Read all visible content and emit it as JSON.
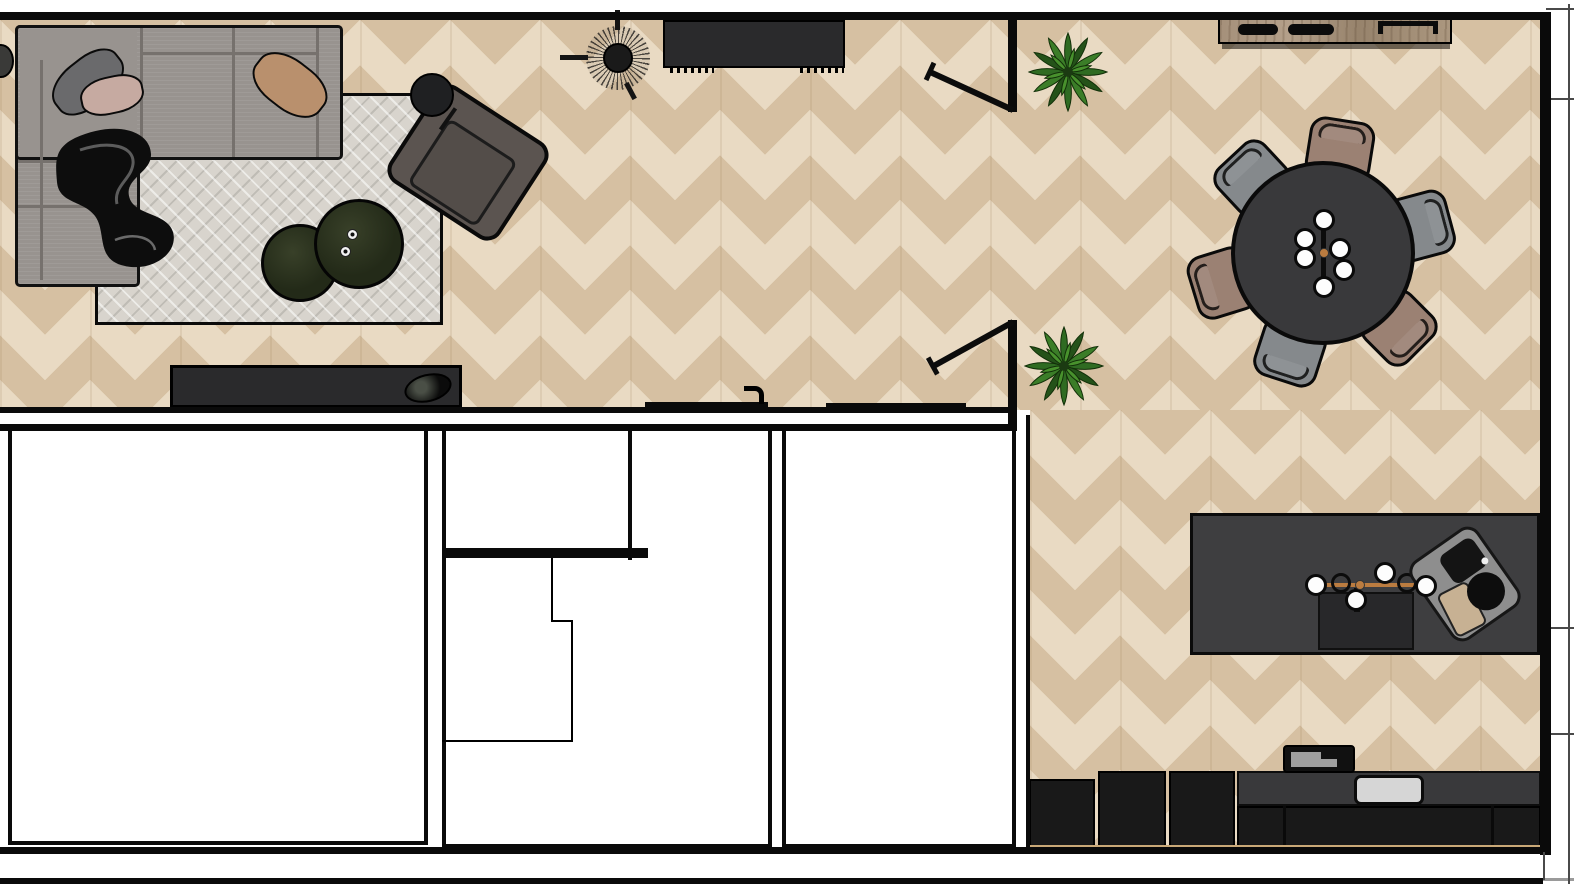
{
  "floorplan": {
    "aria": "Apartment floor plan, top-down rendered view",
    "colors": {
      "wall": "#0a0a0a",
      "floor_base": "#e9dac3",
      "floor_stripe": "#d6c0a2",
      "rug": "#d8d4cd",
      "sofa": "#98938f",
      "sofa_line": "#76716d",
      "pillow_dark": "#6a6a6c",
      "pillow_blush": "#c6aaa1",
      "pillow_tan": "#b9906d",
      "table_dark": "#232a18",
      "armchair": "#5b5450",
      "console": "#2a2a2c",
      "wood": "#a8937c",
      "dining_table": "#39393b",
      "chair_mauve": "#9b8173",
      "chair_gray": "#85898c",
      "island": "#3e3e40",
      "counter": "#39393b",
      "cabinet": "#191919",
      "brass": "#bb7c40",
      "sink": "#d6d6d6",
      "tan_strip": "#c9a877",
      "plant_dark": "#245219",
      "plant_mid": "#2f6b22",
      "plant_light": "#48912d"
    },
    "rooms": [
      {
        "name": "living-room"
      },
      {
        "name": "dining-area"
      },
      {
        "name": "kitchen"
      },
      {
        "name": "room-bottom-left"
      },
      {
        "name": "room-bottom-middle"
      },
      {
        "name": "room-bottom-right"
      }
    ],
    "furniture": [
      "sectional-sofa",
      "throw-pillow-dark",
      "throw-pillow-blush",
      "throw-pillow-tan",
      "throw-blanket",
      "area-rug",
      "nesting-coffee-table-large",
      "nesting-coffee-table-small",
      "candles",
      "floor-lamp",
      "armchair",
      "media-console",
      "decor-bowl",
      "side-stool",
      "ceiling-fan-lamp",
      "entry-console",
      "potted-plant-upper",
      "potted-plant-lower",
      "double-door-leaf-upper",
      "double-door-leaf-lower",
      "sliding-door-left",
      "sliding-door-right",
      "round-dining-table",
      "dining-chairs-x6",
      "branch-chandelier",
      "wood-sideboard",
      "kitchen-island",
      "island-pendant-light",
      "cooktop",
      "serving-tray-with-coffee-set",
      "kitchen-sink",
      "base-cabinets",
      "tall-cabinets-x3",
      "countertop-appliance"
    ]
  }
}
